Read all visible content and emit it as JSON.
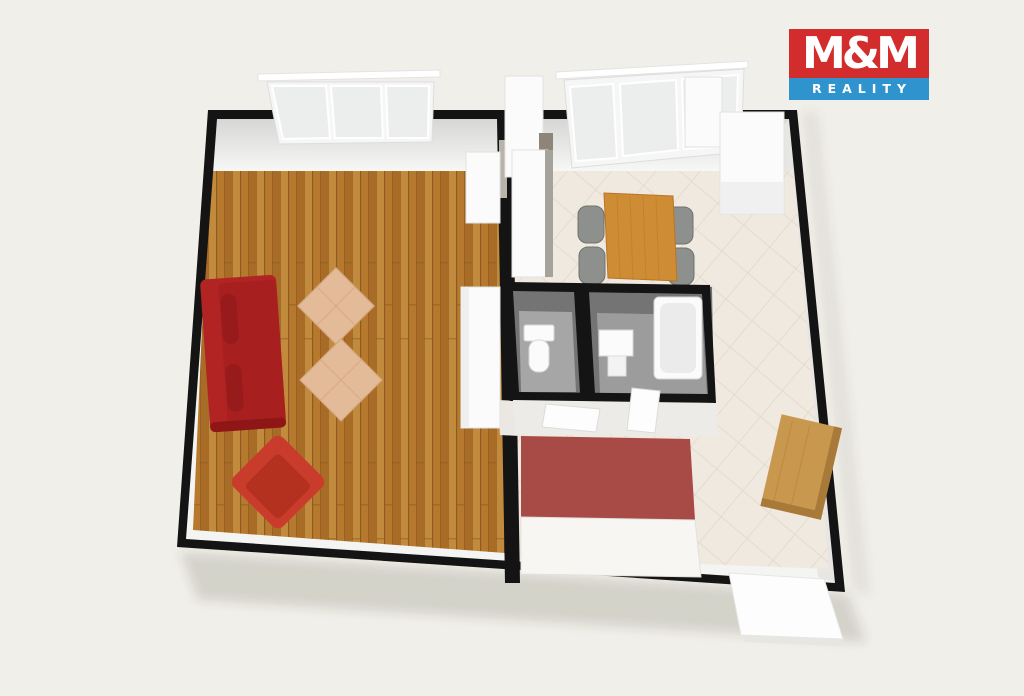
{
  "page": {
    "background": "#f1efe9"
  },
  "logo": {
    "title": "M&M",
    "subtitle": "REALITY"
  },
  "colors": {
    "page-bg": "#f1efe9",
    "brand-red": "#d32c2c",
    "brand-blue": "#2f93cd",
    "logo-text": "#ffffff",
    "wall": "#141414",
    "wood-a": "#b6792e",
    "wood-b": "#a86c27",
    "wood-c": "#c18a3c",
    "wood-line": "#8d5a20",
    "tile": "#efe9e0",
    "tile-line": "#e1d7c9",
    "sofa": "#b22323",
    "sofa-dark": "#971b1b",
    "armchair": "#c93c2b",
    "armchair-seat": "#b4301f",
    "pouf": "#e3bb98",
    "pouf-line": "#d5a67f",
    "bed": "#a84a46",
    "linen": "#f7f6f2",
    "table": "#ce8c34",
    "table-line": "#b87526",
    "chair": "#8d908c",
    "chair-dark": "#70736c",
    "dresser": "#c9984f",
    "dresser-side": "#a87a3a",
    "bath-wall": "#747474",
    "bath-floor": "#a6a6a6",
    "white-furn": "#fbfbfb",
    "furn-edge": "#e2e2e2",
    "fixture": "#fbfbfb",
    "counter-edge": "#a5a29b",
    "appliance": "#8d8579",
    "shadow": "rgba(60,55,45,0.16)"
  }
}
